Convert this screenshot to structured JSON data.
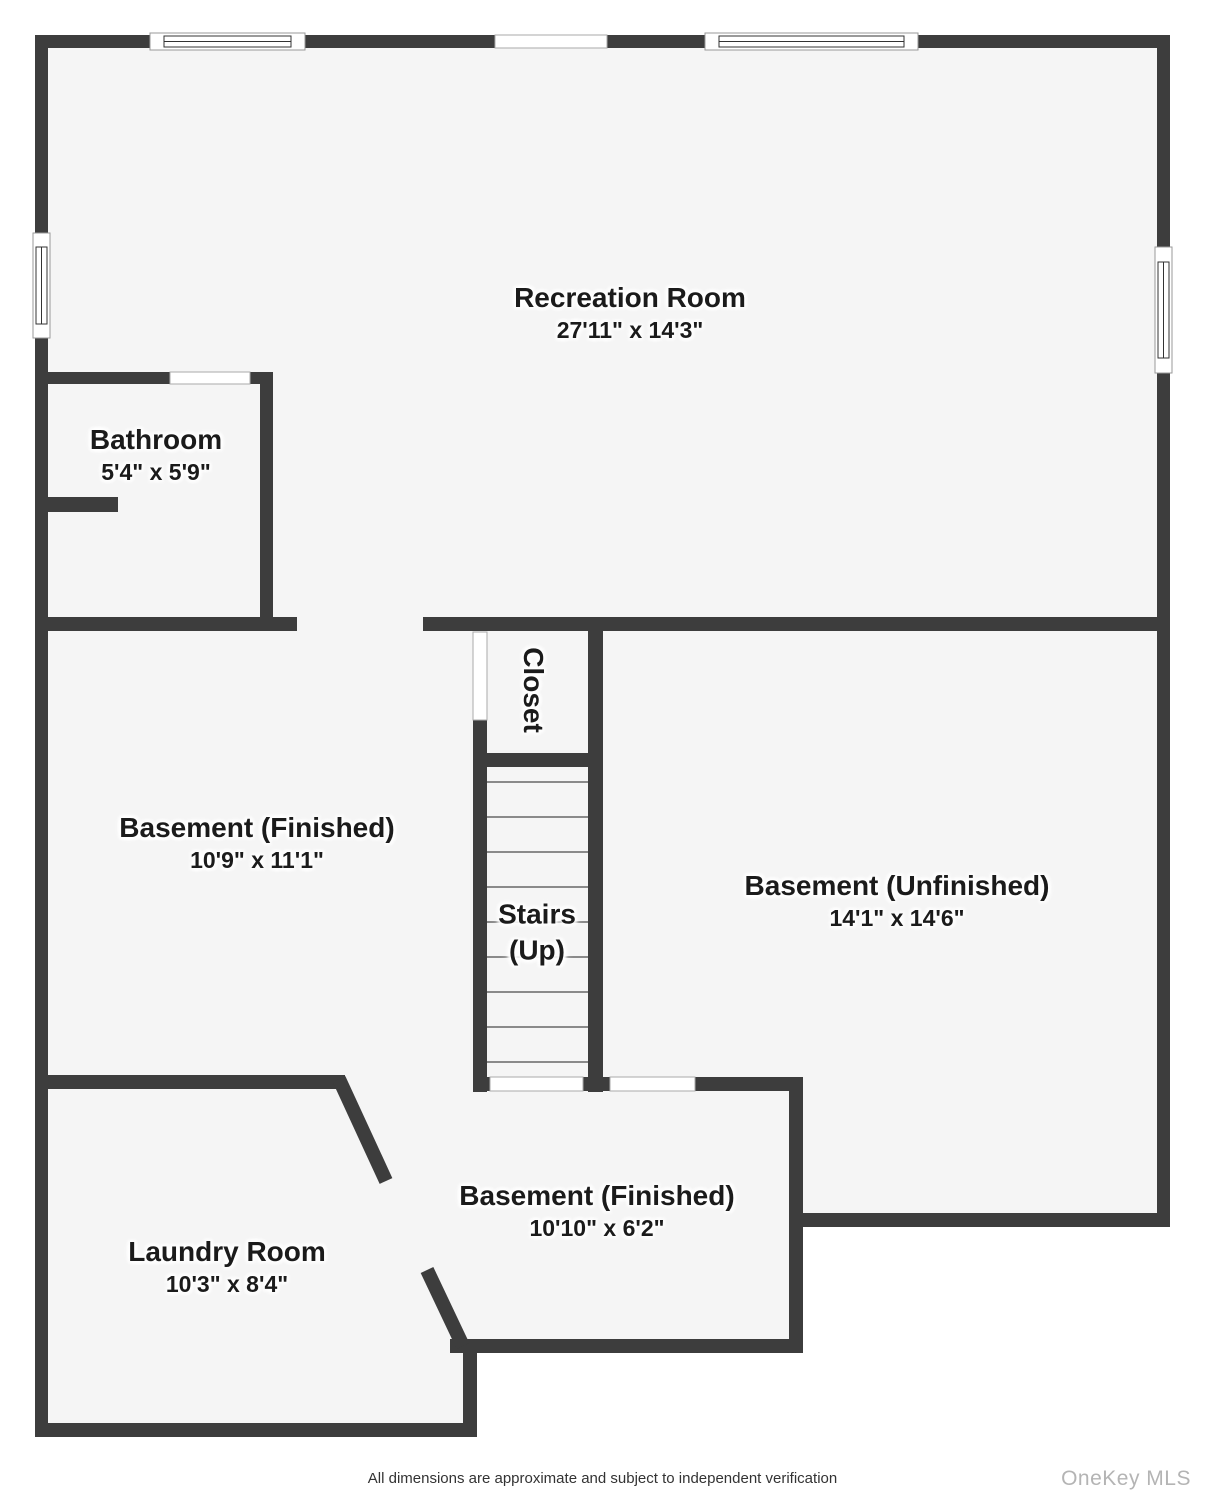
{
  "plan": {
    "rooms": [
      {
        "name": "Recreation Room",
        "dims": "27'11\" x 14'3\""
      },
      {
        "name": "Bathroom",
        "dims": "5'4\" x 5'9\""
      },
      {
        "name": "Closet",
        "dims": ""
      },
      {
        "name": "Basement (Finished)",
        "dims": "10'9\" x 11'1\""
      },
      {
        "name": "Basement (Unfinished)",
        "dims": "14'1\" x 14'6\""
      },
      {
        "name": "Stairs",
        "dims": "(Up)"
      },
      {
        "name": "Basement (Finished)",
        "dims": "10'10\" x 6'2\""
      },
      {
        "name": "Laundry Room",
        "dims": "10'3\" x 8'4\""
      }
    ],
    "footer": "All dimensions are approximate and subject to independent verification",
    "watermark": "OneKey MLS",
    "colors": {
      "wall": "#3d3d3d",
      "floor": "#f5f5f5",
      "text": "#1b1b1b",
      "watermark": "#b4b4b4"
    }
  }
}
